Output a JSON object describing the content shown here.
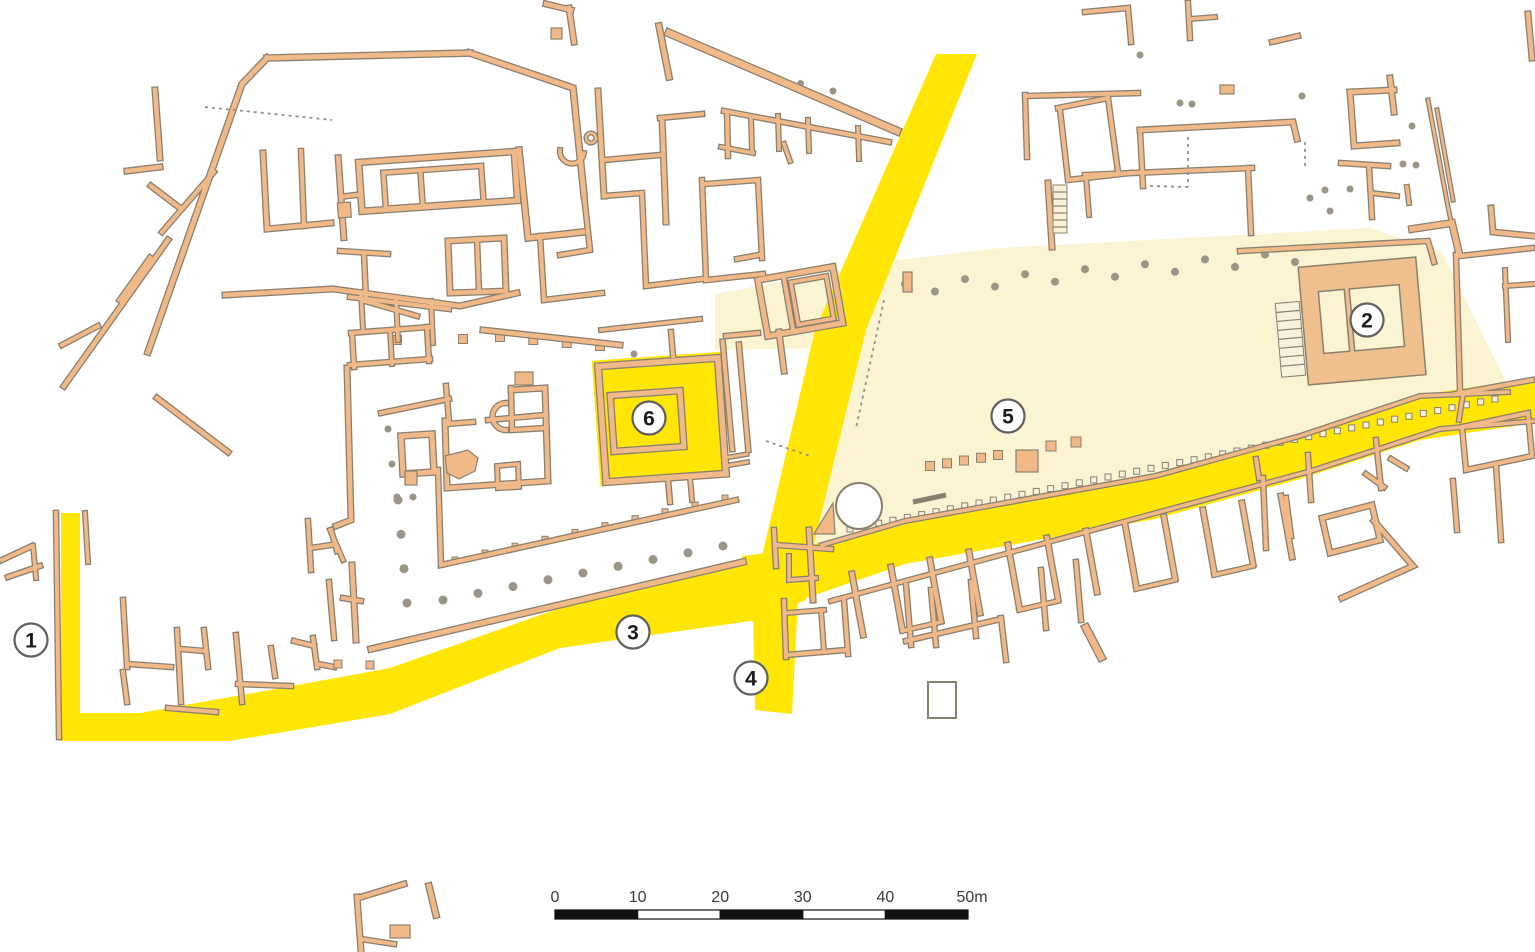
{
  "plan": {
    "type": "Archaeological site plan with highlighted streets and open area",
    "markers": [
      {
        "label": "1"
      },
      {
        "label": "2"
      },
      {
        "label": "3"
      },
      {
        "label": "4"
      },
      {
        "label": "5"
      },
      {
        "label": "6"
      }
    ],
    "scale_bar": {
      "tick_labels": [
        "0",
        "10",
        "20",
        "30",
        "40",
        "50m"
      ]
    },
    "colors": {
      "street_highlight": "#FFE605",
      "open_area_highlight": "#FAF4D2",
      "wall_fill": "#F1B988",
      "wall_outline": "#8A8070",
      "temple_platform": "#EFC08E",
      "background": "#FFFFFF"
    }
  }
}
